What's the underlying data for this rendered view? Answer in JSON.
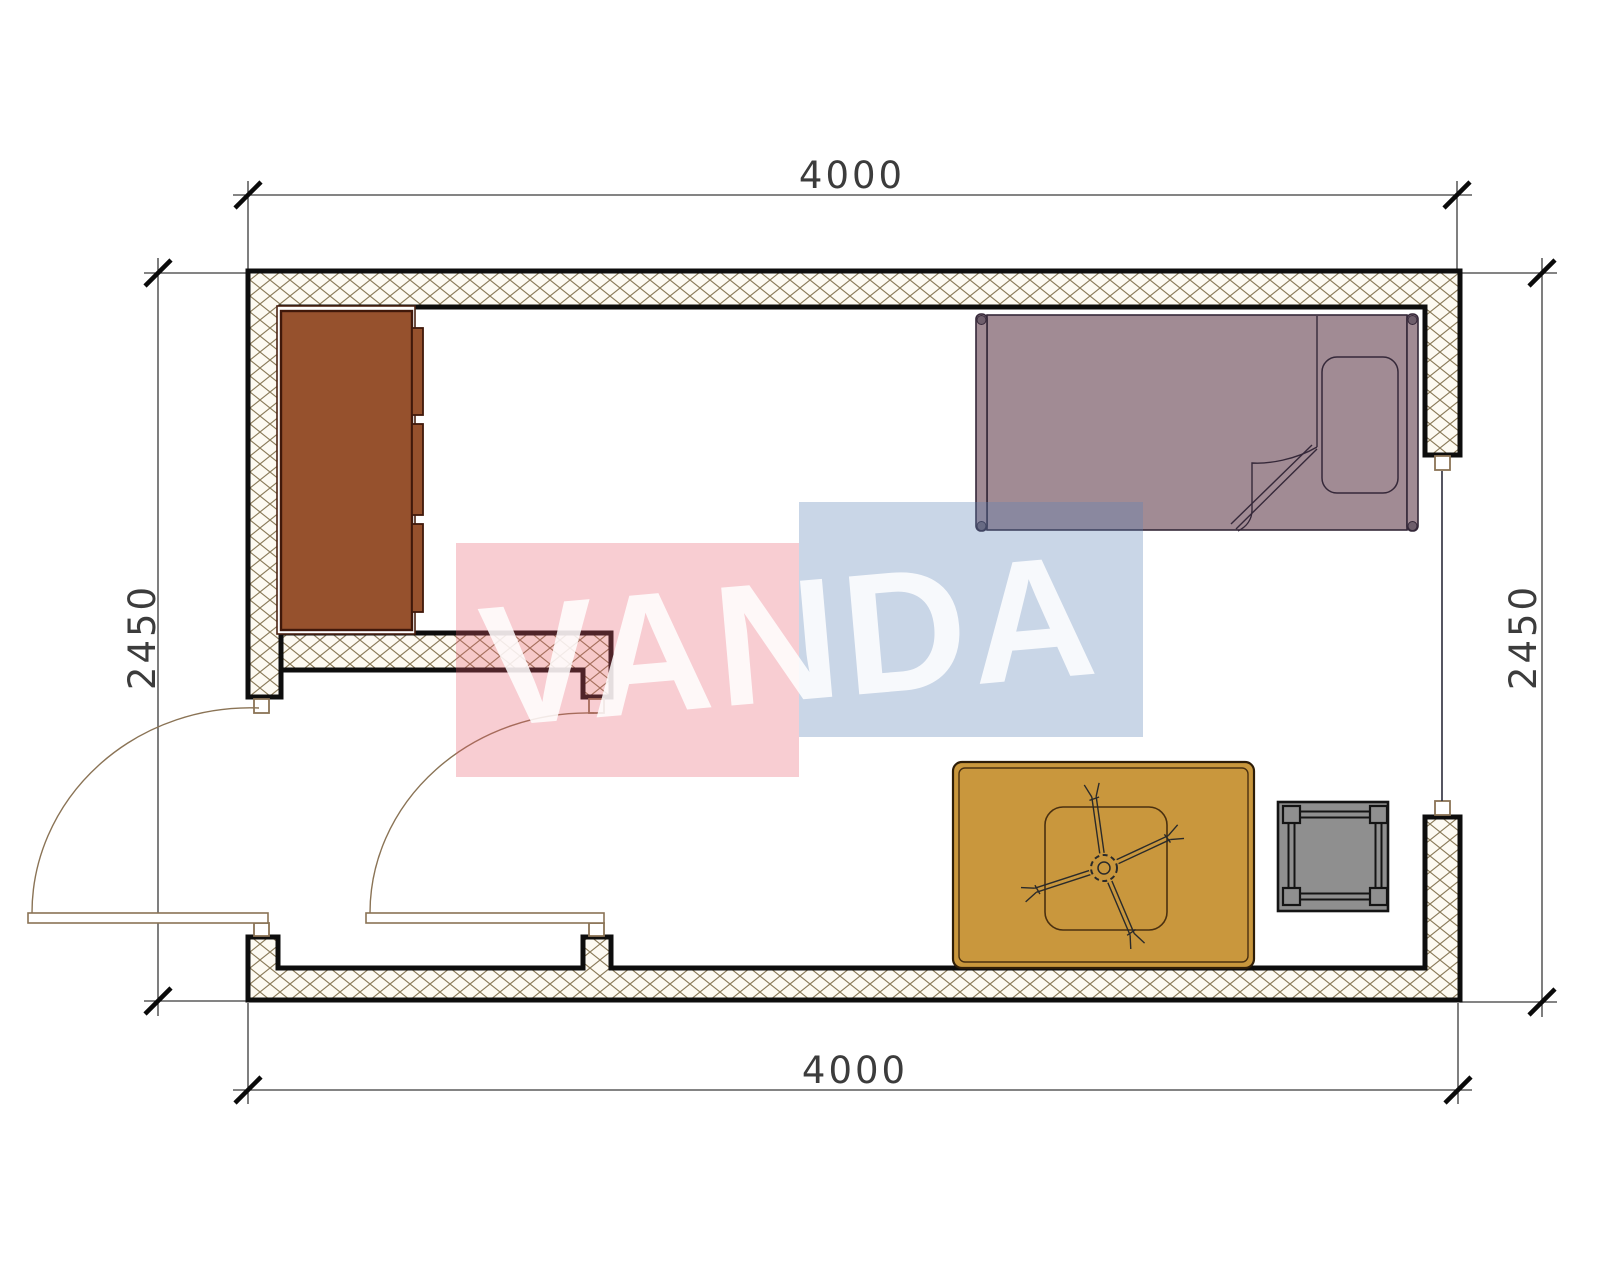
{
  "drawing": {
    "dimensions": {
      "top": "4000",
      "bottom": "4000",
      "left": "2450",
      "right": "2450"
    },
    "watermark": {
      "text": "VANDA",
      "pink": "rgba(233,88,106,0.30)",
      "blue": "rgba(90,130,182,0.33)",
      "text_color": "rgba(255,255,255,0.85)"
    },
    "colors": {
      "wall_stroke": "#0d0d0d",
      "hatch_line": "#8a7a58",
      "door": "#8a7355",
      "window_line": "#2b2b3a",
      "wardrobe": "#96512d",
      "wardrobe_stroke": "#40180a",
      "bed": "#a18b94",
      "bed_stroke": "#352839",
      "bed_cap": "#6e5e6b",
      "table": "#c9973d",
      "table_stroke": "#2e1d08",
      "table_inner_stroke": "#4a3010",
      "fan_stroke": "#2a2a2a",
      "stool": "#8f8f8f",
      "stool_stroke": "#141414",
      "dim_line": "#3a3a3a",
      "tick": "#0a0a0a"
    }
  }
}
